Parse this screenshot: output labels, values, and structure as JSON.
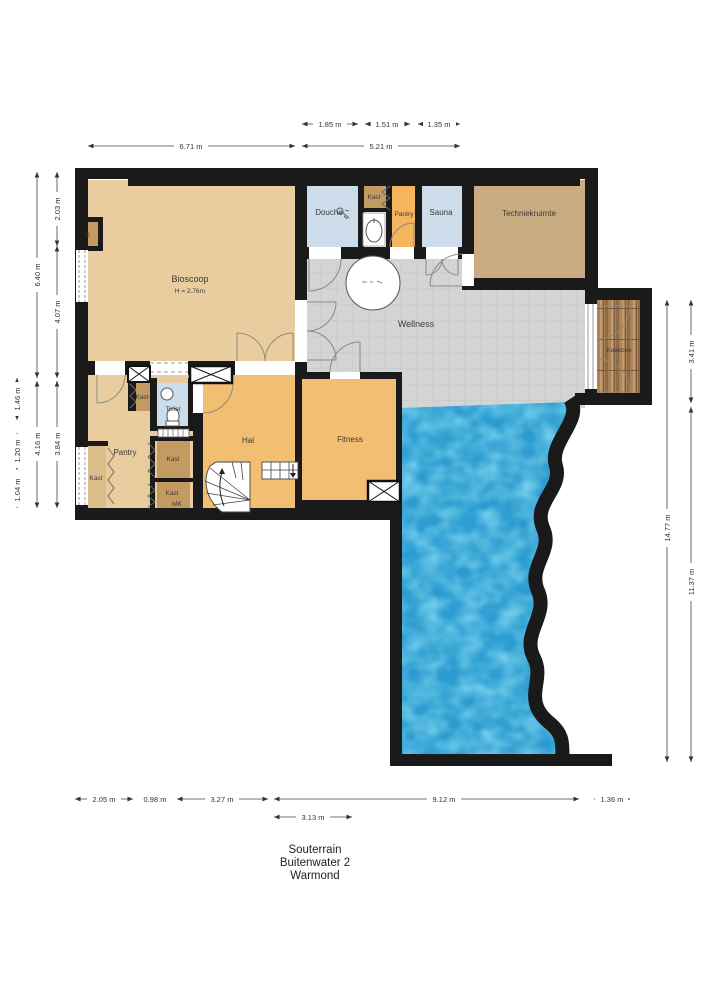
{
  "plan": {
    "type": "floorplan",
    "floor_label": "Souterrain",
    "address_line": "Buitenwater 2",
    "city_line": "Warmond"
  },
  "rooms": {
    "bioscoop": {
      "name": "Bioscoop",
      "height_note": "H = 2.76m"
    },
    "k": "K",
    "douche": "Douche",
    "kast_top": "Kast",
    "pantry_top": "Pantry",
    "sauna": "Sauna",
    "techniekruimte": "Techniekruimte",
    "wellness": "Wellness",
    "koekoek": "Koekoek",
    "kast_hal": "Kast",
    "toilet": "Toilet",
    "pantry": "Pantry",
    "kast_left": "Kast",
    "kast_mid": "Kast",
    "kast_bottom": "Kast",
    "mk": "MK",
    "hal": "Hal",
    "fitness": "Fitness"
  },
  "dimensions": {
    "top_segments": [
      "1.85 m",
      "1.51 m",
      "1.35 m"
    ],
    "top_totals": [
      "6.71 m",
      "5.21 m"
    ],
    "left_segments": [
      "2.03 m",
      "4.07 m",
      "3.84 m"
    ],
    "left_totals": [
      "6.40 m",
      "4.16 m"
    ],
    "left_outer_segments": [
      "1.46 m",
      "1.20 m",
      "1.04 m"
    ],
    "right_total": "14.77 m",
    "right_segments": [
      "3.41 m",
      "11.37 m"
    ],
    "bottom_segments": [
      "2.05 m",
      "0.98 m",
      "3.27 m",
      "9.12 m",
      "1.36 m"
    ],
    "bottom_secondary": "3.13 m"
  },
  "colors": {
    "wall": "#1a1a1a",
    "room_tan": "#e9cd9e",
    "room_orange": "#f2bf72",
    "pantry_orange": "#f4b55e",
    "closet_brown": "#c49a63",
    "wet_room_blue": "#ccdcea",
    "technical_tan": "#c9ac82",
    "wellness_gray": "#d4d4d4",
    "pool_blue": "#2a9ad0",
    "wood_brown": "#ad8257"
  }
}
